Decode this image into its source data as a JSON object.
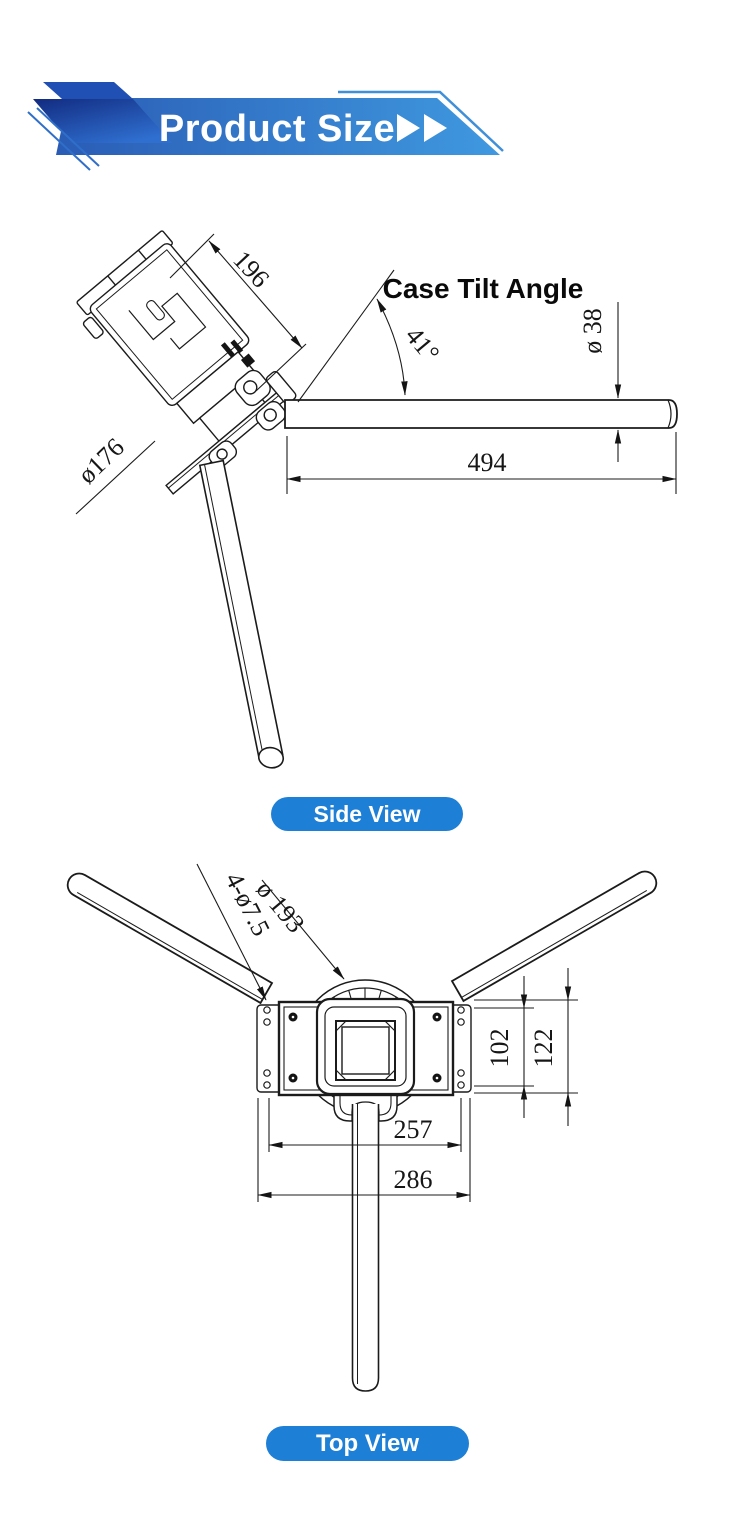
{
  "header": {
    "title": "Product Size",
    "arrows_icon": "double-play-arrows",
    "colors": {
      "banner_gradient_start": "#2a5cb5",
      "banner_gradient_end": "#3f99e0",
      "ribbon_dark": "#16338f",
      "accent_line": "#3f8fd9",
      "title_color": "#ffffff"
    }
  },
  "side_view": {
    "label": "Side View",
    "angle_label": "Case Tilt Angle",
    "dims": {
      "case_length": "196",
      "flange_diameter": "ø176",
      "tilt_angle": "41°",
      "pole_diameter": "ø 38",
      "pole_length": "494"
    }
  },
  "top_view": {
    "label": "Top View",
    "dims": {
      "mount_holes": "4-ø7.5",
      "guard_diameter": "ø 193",
      "hole_spacing_vertical": "102",
      "bracket_height": "122",
      "hole_spacing_horizontal": "257",
      "bracket_width": "286"
    }
  },
  "colors": {
    "pill_blue": "#1d7fd6",
    "drawing_line": "#1b1b1b"
  }
}
